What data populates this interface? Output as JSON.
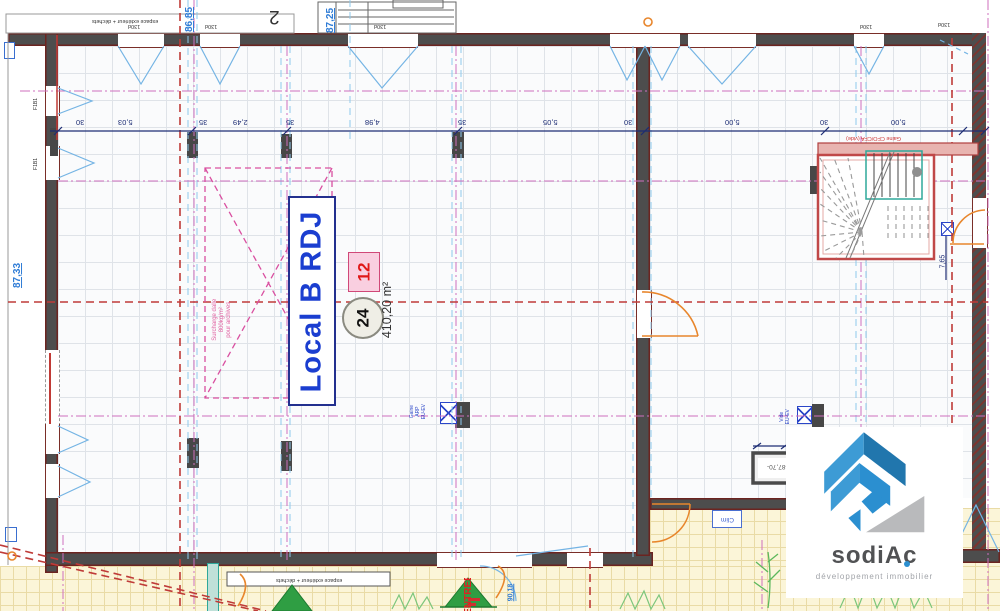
{
  "room": {
    "name": "Local B RDJ",
    "lot_number": "12",
    "parking_count": "24",
    "area": "410,20 m²"
  },
  "axis_label": "2",
  "levels": {
    "top_left": "86,85",
    "top_mid": "87,25",
    "left": "87,33",
    "shaft": "-87,70-",
    "bottom": "90,18"
  },
  "dimensions": {
    "top_row": [
      "30",
      "5,03",
      "35",
      "2,49",
      "35",
      "4,98",
      "35",
      "5,05",
      "30",
      "5,00",
      "30",
      "5,00"
    ],
    "right_vertical": "7,65"
  },
  "annotations": {
    "surcharge_line1": "Surcharge dalle",
    "surcharge_line2": "800kg/m²",
    "surcharge_line3": "pour archives",
    "gaine_cfo": "Gaine CFO/CFA (vide)",
    "gaine_line1": "Gaine",
    "gaine_line2": "ARP",
    "gaine_line3": "EU-EV",
    "vide_line1": "Vide",
    "vide_line2": "EU-EV",
    "clim": "Clim",
    "entree": "ENTREE",
    "exterior_note": "espace extérieur + déchets",
    "window_label": "130d",
    "door_label": "F1B1"
  },
  "logo": {
    "name": "sodiAc",
    "tagline": "développement immobilier"
  },
  "colors": {
    "wall": "#4d4d4d",
    "accent_red": "#bf3b38",
    "accent_magenta": "#cf6fbe",
    "accent_blue": "#8ec9ec",
    "navy": "#1d2d74",
    "room_blue": "#1b3ed0",
    "orange": "#e8862c",
    "teal": "#2fa89a",
    "green": "#2f9e43",
    "logo_blue": "#2b8fd0",
    "logo_gray": "#b9babc"
  }
}
